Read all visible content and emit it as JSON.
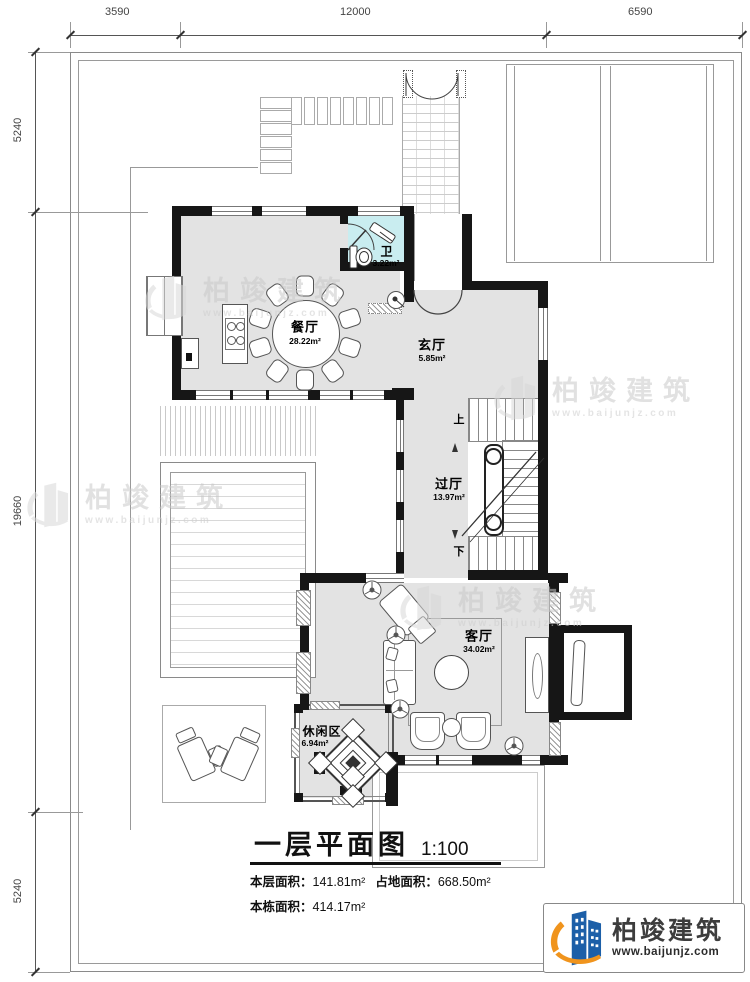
{
  "dimensions": {
    "top": [
      "3590",
      "12000",
      "6590"
    ],
    "left": [
      "5240",
      "19660",
      "5240"
    ]
  },
  "rooms": {
    "dining": {
      "name": "餐厅",
      "area": "28.22m²"
    },
    "bath": {
      "name": "卫",
      "area": "3.22m²"
    },
    "foyer": {
      "name": "玄厅",
      "area": "5.85m²"
    },
    "hall": {
      "name": "过厅",
      "area": "13.97m²"
    },
    "living": {
      "name": "客厅",
      "area": "34.02m²"
    },
    "leisure": {
      "name": "休闲区",
      "area": "6.94m²"
    }
  },
  "stairs": {
    "up": "上",
    "down": "下"
  },
  "title": {
    "text": "一层平面图",
    "scale": "1:100"
  },
  "areas": {
    "floor_label": "本层面积：",
    "floor_value": "141.81m²",
    "site_label": "占地面积：",
    "site_value": "668.50m²",
    "building_label": "本栋面积：",
    "building_value": "414.17m²"
  },
  "watermark": {
    "title": "柏竣建筑",
    "url": "www.baijunjz.com"
  },
  "logo": {
    "name": "柏竣建筑",
    "url": "www.baijunjz.com"
  },
  "colors": {
    "wall": "#161616",
    "floor": "#e3e3e3",
    "bathroom_floor": "#c9edf0",
    "logo_blue": "#1c5fa8",
    "logo_orange": "#f0941d",
    "watermark_gray": "#cccccc"
  }
}
